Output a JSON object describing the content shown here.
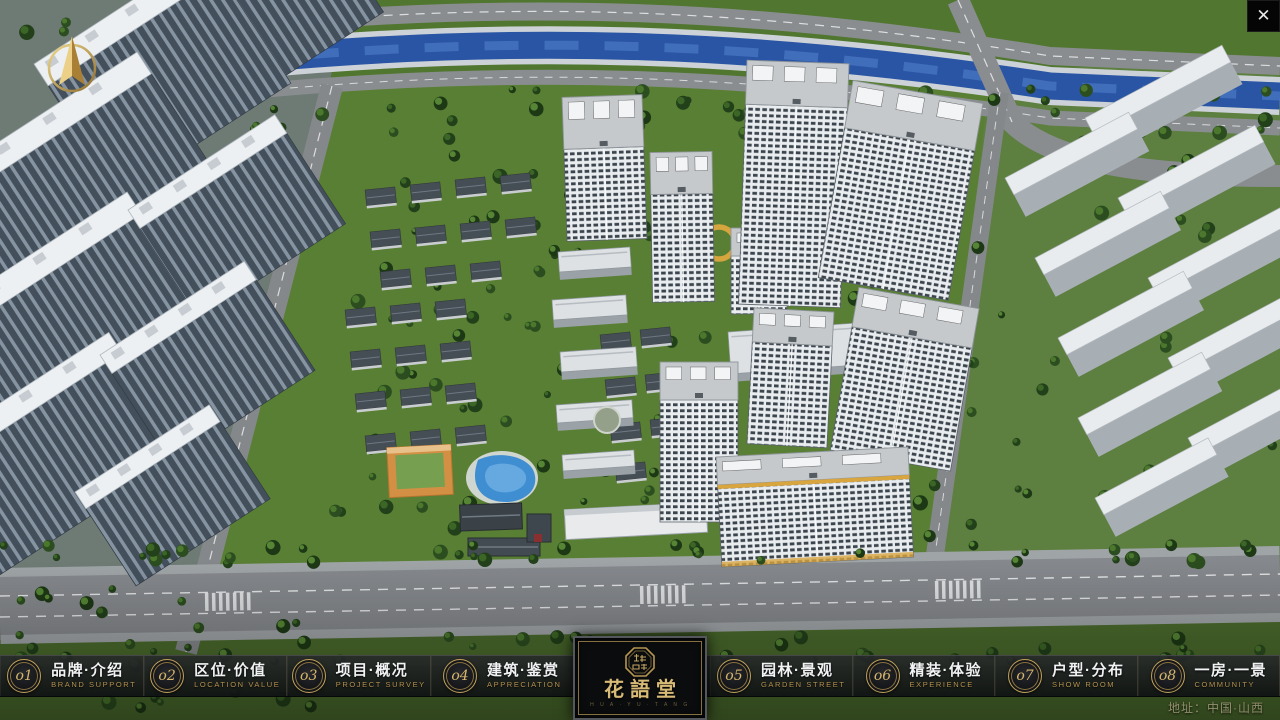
{
  "window": {
    "close_icon": "✕"
  },
  "nav": {
    "items": [
      {
        "num": "o1",
        "zh": "品牌·介绍",
        "en": "BRAND SUPPORT"
      },
      {
        "num": "o2",
        "zh": "区位·价值",
        "en": "LOCATION VALUE"
      },
      {
        "num": "o3",
        "zh": "项目·概况",
        "en": "PROJECT SURVEY"
      },
      {
        "num": "o4",
        "zh": "建筑·鉴赏",
        "en": "APPRECIATION"
      },
      {
        "num": "o5",
        "zh": "园林·景观",
        "en": "GARDEN STREET"
      },
      {
        "num": "o6",
        "zh": "精装·体验",
        "en": "EXPERIENCE"
      },
      {
        "num": "o7",
        "zh": "户型·分布",
        "en": "SHOW ROOM"
      },
      {
        "num": "o8",
        "zh": "一房·一景",
        "en": "COMMUNITY"
      }
    ]
  },
  "logo": {
    "title": "花語堂",
    "subtitle": "H U A · Y U · T A N G"
  },
  "footer": {
    "address": "地址：中国·山西"
  },
  "colors": {
    "gold": "#c9a85f",
    "bar_bg": "#101214",
    "river": "#2a55a4"
  }
}
